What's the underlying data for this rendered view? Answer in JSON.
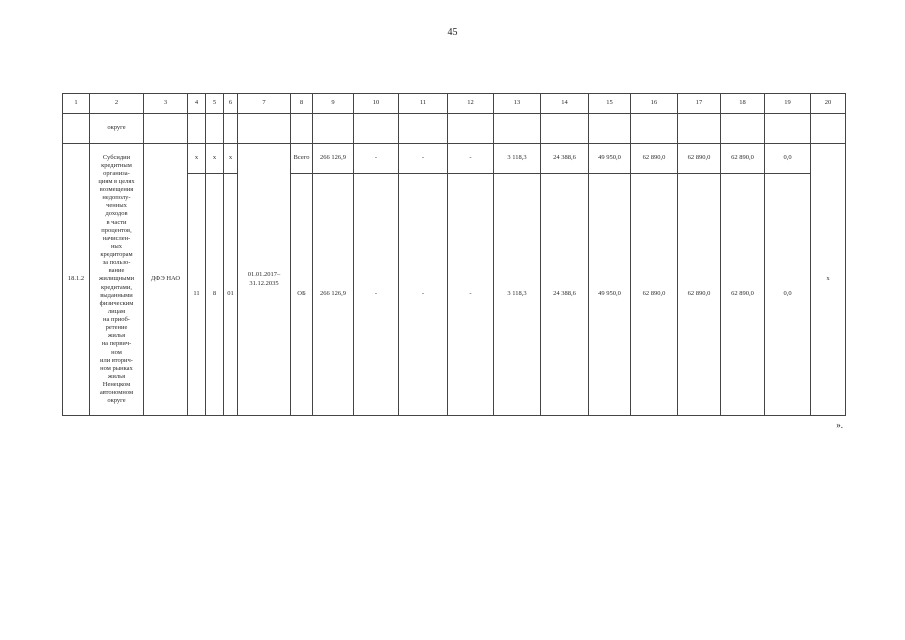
{
  "page": {
    "number": "45",
    "closing_mark": "»."
  },
  "table": {
    "column_numbers": [
      "1",
      "2",
      "3",
      "4",
      "5",
      "6",
      "7",
      "8",
      "9",
      "10",
      "11",
      "12",
      "13",
      "14",
      "15",
      "16",
      "17",
      "18",
      "19",
      "20"
    ],
    "carryover": {
      "name_continuation": "округе"
    },
    "row": {
      "index": "18.1.2",
      "title": "Субсидии\nкредитным\nорганиза-\nциям в целях\nвозмещения\nнедополу-\nченных\nдоходов\nв части\nпроцентов,\nначислен-\nных\nкредиторам\nза пользо-\nвание\nжилищными\nкредитами,\nвыданными\nфизическим\nлицам\nна приоб-\nретение\nжилья\nна первич-\nном\nили вторич-\nном рынках\nжилья\nНенецком\nавтономном\nокруге",
      "executor": "ДФЭ НАО",
      "codes_top": [
        "х",
        "х",
        "х"
      ],
      "codes_bottom": [
        "11",
        "8",
        "01"
      ],
      "period": "01.01.2017–\n31.12.2035",
      "flag_col20": "х",
      "total": {
        "label": "Всего",
        "values": [
          "266 126,9",
          "-",
          "-",
          "-",
          "3 118,3",
          "24 388,6",
          "49 950,0",
          "62 890,0",
          "62 890,0",
          "62 890,0",
          "0,0"
        ]
      },
      "budget": {
        "label": "ОБ",
        "values": [
          "266 126,9",
          "-",
          "-",
          "-",
          "3 118,3",
          "24 388,6",
          "49 950,0",
          "62 890,0",
          "62 890,0",
          "62 890,0",
          "0,0"
        ]
      }
    }
  }
}
